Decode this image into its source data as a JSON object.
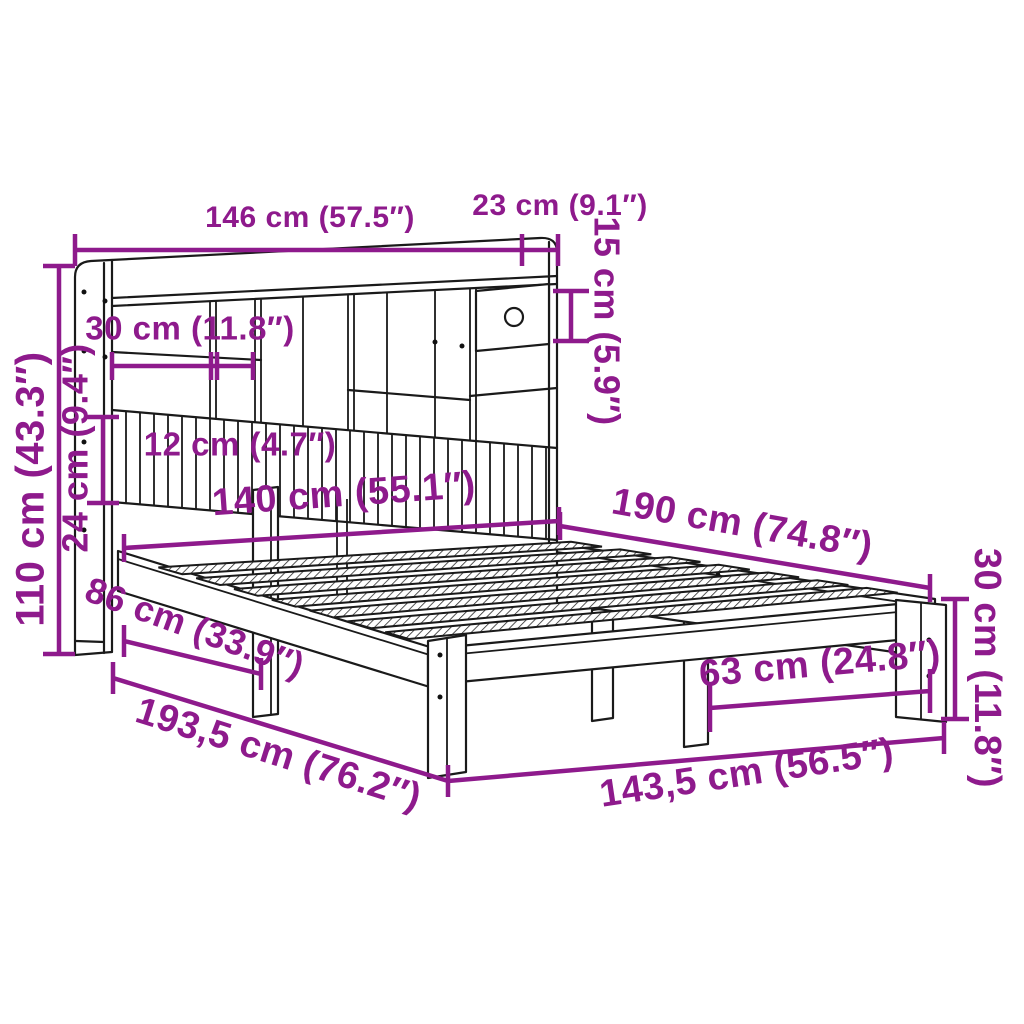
{
  "diagram": {
    "type": "product-dimension-diagram",
    "subject": "bookcase bed frame with shelf headboard and drawer",
    "background_color": "#FFFFFF",
    "line_color": "#1A1A1A",
    "accent_color": "#8E1A8C",
    "dims": {
      "d146": "146 cm (57.5″)",
      "d23": "23 cm (9.1″)",
      "d15": "15 cm (5.9″)",
      "d30_headboard": "30 cm (11.8″)",
      "d12": "12 cm (4.7″)",
      "d110": "110 cm (43.3″)",
      "d24": "24 cm (9.4″)",
      "d140": "140 cm (55.1″)",
      "d190": "190 cm (74.8″)",
      "d86": "86 cm (33.9″)",
      "d30_frame": "30 cm (11.8″)",
      "d63": "63 cm (24.8″)",
      "d193_5": "193,5 cm (76.2″)",
      "d143_5": "143,5 cm (56.5″)"
    }
  }
}
